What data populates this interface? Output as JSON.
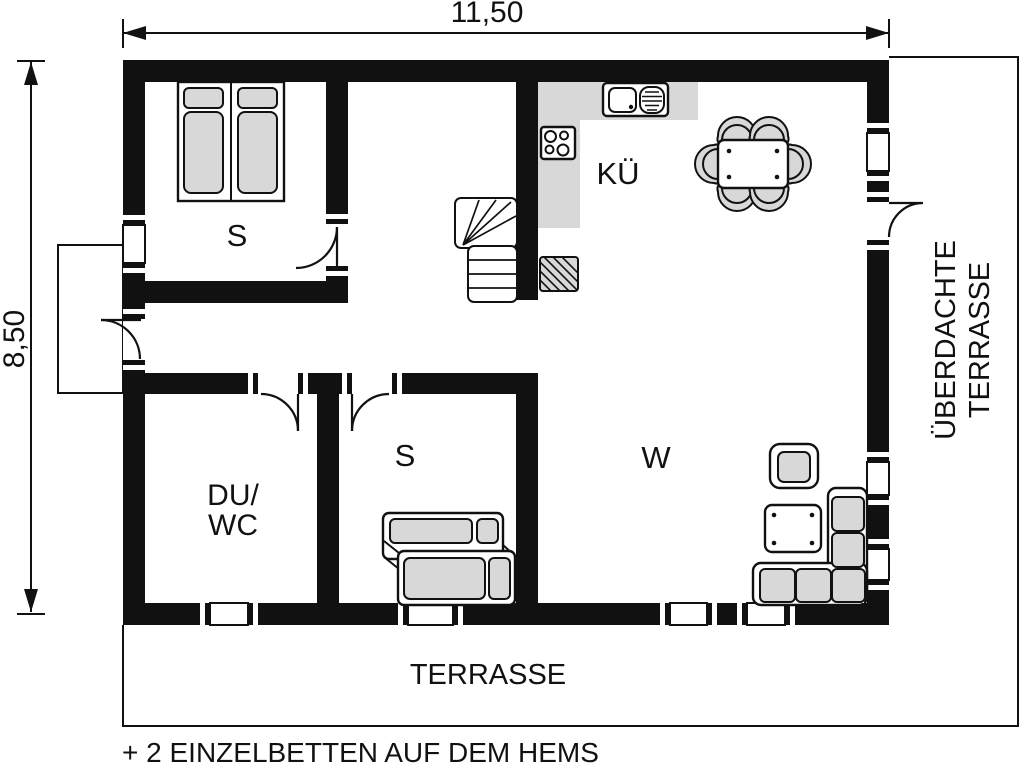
{
  "dimensions": {
    "width_label": "11,50",
    "height_label": "8,50"
  },
  "rooms": {
    "bedroom_top": "S",
    "kitchen": "KÜ",
    "shower_wc_line1": "DU/",
    "shower_wc_line2": "WC",
    "bedroom_bottom": "S",
    "living": "W",
    "terrace": "TERRASSE",
    "covered_terrace_line1": "ÜBERDACHTE",
    "covered_terrace_line2": "TERRASSE"
  },
  "caption": "+ 2 EINZELBETTEN AUF DEM HEMS",
  "colors": {
    "wall": "#111111",
    "furniture_fill": "#d8d8d8",
    "background": "#ffffff"
  }
}
